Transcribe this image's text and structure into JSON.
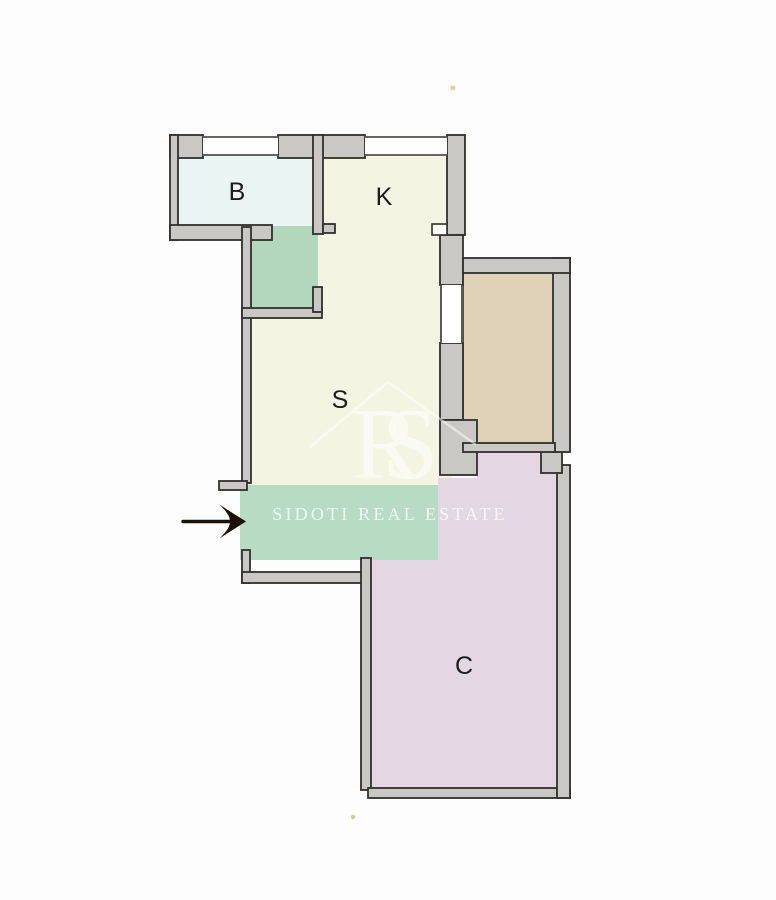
{
  "page": {
    "background": "#fdfdfd"
  },
  "plan": {
    "wall_color": "#c9c8c4",
    "outline_color": "#30302c",
    "arrow_color": "#1d1008",
    "rooms": [
      {
        "id": "B",
        "label": "B",
        "color": "#eaf4f2",
        "meaning": "bathroom"
      },
      {
        "id": "K",
        "label": "K",
        "color": "#f3f4e1",
        "meaning": "kitchen"
      },
      {
        "id": "S",
        "label": "S",
        "color": "#f3f4e1",
        "meaning": "living-room"
      },
      {
        "id": "C",
        "label": "C",
        "color": "#e4d6e2",
        "meaning": "bedroom"
      }
    ],
    "areas": [
      {
        "id": "closet",
        "color": "#b2d7bd",
        "meaning": "green-highlight-closet"
      },
      {
        "id": "entry-band",
        "color": "#b7dbc3",
        "meaning": "green-highlight-entrance"
      },
      {
        "id": "balcony",
        "color": "#ded1b8",
        "meaning": "balcony-terrace"
      }
    ],
    "icons": [
      {
        "id": "entry-arrow",
        "meaning": "entrance-direction-arrow",
        "color": "#1d1008"
      }
    ],
    "specks": [
      {
        "x": 453,
        "y": 88,
        "color": "#e2c476"
      },
      {
        "x": 353,
        "y": 817,
        "color": "#cbc167"
      }
    ]
  },
  "watermark": {
    "logo": "RS",
    "brand": "SIDOTI REAL ESTATE",
    "color": "#ffffff"
  }
}
